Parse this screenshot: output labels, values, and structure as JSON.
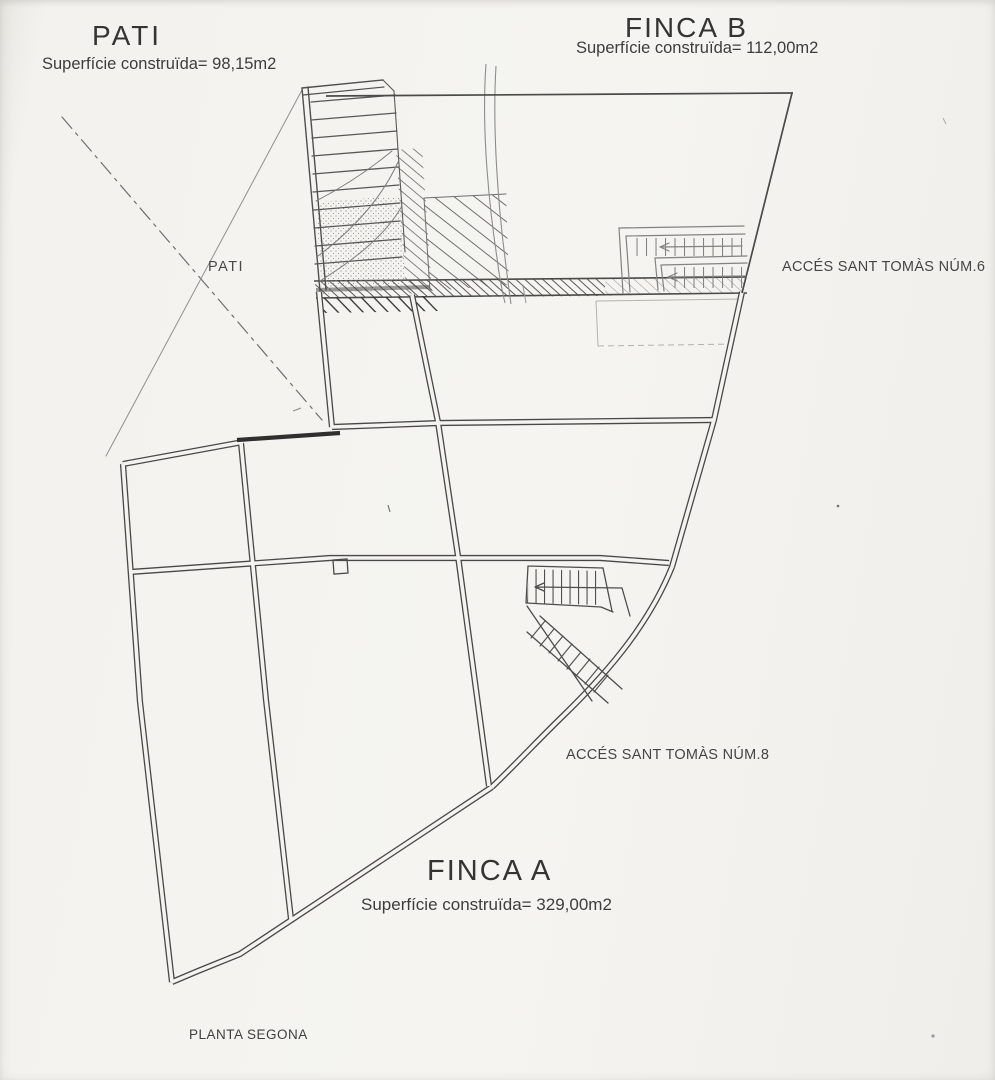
{
  "plan": {
    "name": "PLANTA SEGONA",
    "zones": {
      "pati": {
        "title": "PATI",
        "area": "Superfície construïda= 98,15m2"
      },
      "finca_b": {
        "title": "FINCA B",
        "area": "Superfície construïda= 112,00m2"
      },
      "finca_a": {
        "title": "FINCA A",
        "area": "Superfície construïda= 329,00m2"
      }
    },
    "room_labels": {
      "pati_courtyard": "PATI"
    },
    "access_notes": {
      "num6": "ACCÉS SANT TOMÀS NÚM.6",
      "num8": "ACCÉS SANT TOMÀS NÚM.8"
    },
    "colors": {
      "paper": "#f4f3ef",
      "ink": "#3b3b3b",
      "pencil": "#8a8a8a"
    }
  }
}
